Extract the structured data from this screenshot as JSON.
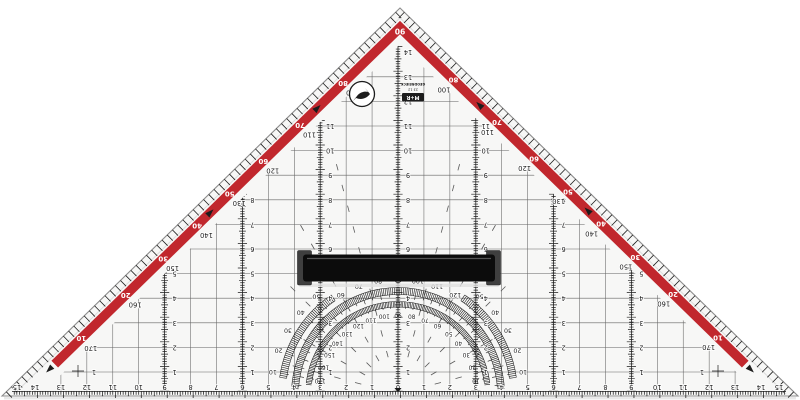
{
  "object_label": "transparent set square with protractor and removable grip",
  "colors": {
    "background": "#ffffff",
    "plastic_fill": "#f7f7f6",
    "edge_stroke": "#8c8c8c",
    "bevel_stroke": "#dcdcdc",
    "ink": "#1c1c1c",
    "grid_line": "#4a4a4a",
    "guide_line": "#5a5a5a",
    "red_band": "#c1272d",
    "white_digits": "#ffffff",
    "handle_bar": "#0c0c0c",
    "handle_highlight": "#555555",
    "handle_clamp": "#3f3f3f",
    "shadow": "#e0e0e0"
  },
  "apex_degree_label": "90",
  "hypotenuse_cm_scale": {
    "numbers": [
      15,
      14,
      13,
      12,
      11,
      10,
      9,
      8,
      7,
      6,
      5,
      4,
      3,
      2,
      1,
      0,
      1,
      2,
      3,
      4,
      5,
      6,
      7,
      8,
      9,
      10,
      11,
      12,
      13,
      14,
      15
    ]
  },
  "edge_degree_pairs": [
    {
      "white": "10",
      "black": "170"
    },
    {
      "white": "20",
      "black": "160"
    },
    {
      "white": "30",
      "black": "150"
    },
    {
      "white": "40",
      "black": "140"
    },
    {
      "white": "50",
      "black": "130"
    },
    {
      "white": "60",
      "black": "120"
    },
    {
      "white": "70",
      "black": "110"
    },
    {
      "white": "80",
      "black": "100"
    }
  ],
  "protractor": {
    "top_labels": [
      "120",
      "110",
      "100",
      "90",
      "80",
      "70",
      "60"
    ],
    "inner_labels": [
      "10",
      "20",
      "30",
      "40",
      "50",
      "60",
      "70",
      "80",
      "90",
      "100",
      "110",
      "120",
      "130",
      "140",
      "150",
      "160",
      "170"
    ],
    "side_labels": [
      "10",
      "20",
      "30",
      "40",
      "50"
    ]
  },
  "columns": [
    {
      "x_offset_cm": 0,
      "labels": [
        "1",
        "2",
        "3",
        "4",
        "5",
        "6",
        "7",
        "8",
        "9",
        "10",
        "11",
        "12",
        "13",
        "14"
      ]
    },
    {
      "x_offset_cm": 3,
      "labels": [
        "1",
        "2",
        "3",
        "4",
        "5",
        "6",
        "7",
        "8",
        "9",
        "10",
        "11"
      ]
    },
    {
      "x_offset_cm": 6,
      "labels": [
        "1",
        "2",
        "3",
        "4",
        "5",
        "6",
        "7",
        "8"
      ]
    },
    {
      "x_offset_cm": 9,
      "labels": [
        "1",
        "2",
        "3",
        "4",
        "5"
      ]
    }
  ],
  "corner_mark_label": "1",
  "logo": {
    "line1": "GEODREIECK",
    "line2": "23 12",
    "brand_badge": "M+R"
  }
}
